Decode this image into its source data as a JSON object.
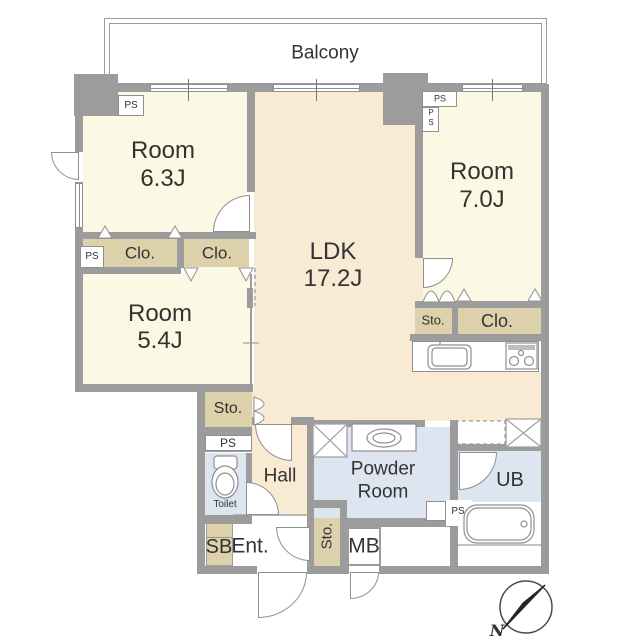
{
  "title": "Apartment floor plan",
  "labels": {
    "balcony": "Balcony",
    "room": "Room",
    "size_6_3": "6.3J",
    "size_5_4": "5.4J",
    "size_7_0": "7.0J",
    "ldk": "LDK",
    "ldk_size": "17.2J",
    "clo": "Clo.",
    "sto": "Sto.",
    "ps": "PS",
    "p": "P",
    "s": "S",
    "hall": "Hall",
    "powder_line1": "Powder",
    "powder_line2": "Room",
    "ub": "UB",
    "toilet": "Toilet",
    "sb": "SB",
    "ent": "Ent.",
    "mb": "MB",
    "north": "N"
  },
  "icons": {
    "toilet": "toilet-icon",
    "washbasin": "washbasin-icon",
    "bathtub": "bathtub-icon",
    "kitchen_sink": "kitchen-sink-icon",
    "stove": "stove-icon",
    "compass": "north-compass-icon",
    "washer_pan": "washer-pan-marker",
    "refrigerator_space": "refrigerator-space-marker"
  },
  "colors": {
    "wall": "#9c9c9c",
    "outline": "#8f8f8f",
    "bedroom_floor": "#fbf8e3",
    "living_floor": "#f9ead4",
    "closet_floor": "#dcd1ab",
    "wet_area_floor": "#dde5f0",
    "white": "#ffffff",
    "text": "#333333",
    "compass_needle": "#2b2320"
  }
}
